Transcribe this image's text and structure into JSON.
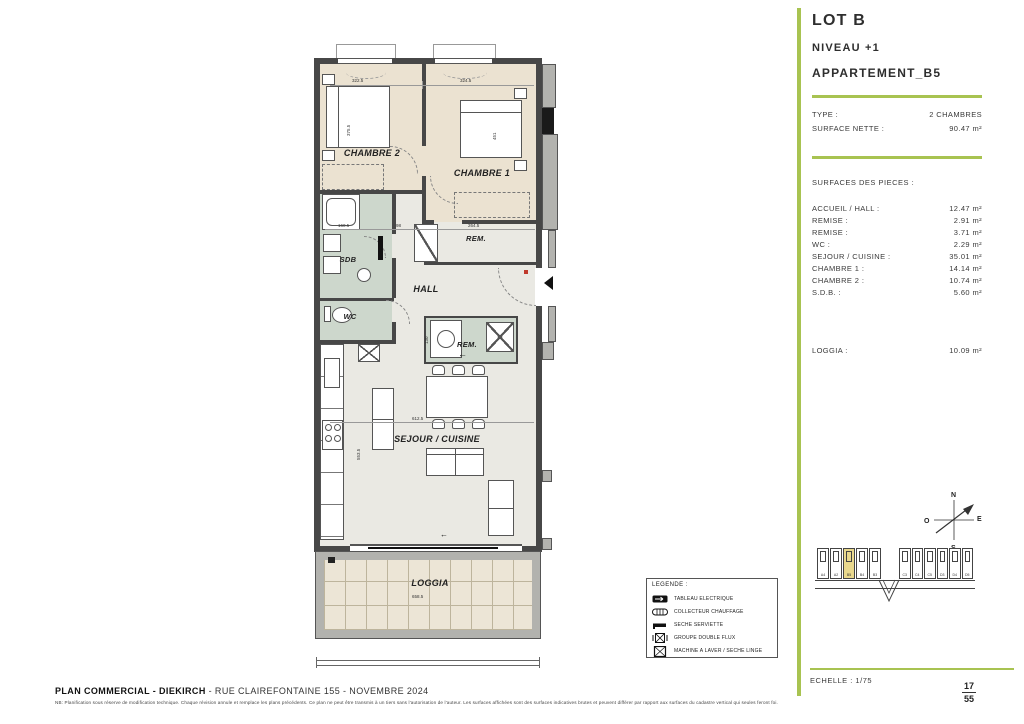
{
  "colors": {
    "accent_green": "#a8c351",
    "room_beige": "#ebe2d1",
    "room_wet": "#cdd7cc",
    "floor": "#eae9e3",
    "wall": "#474747",
    "poche": "#b3b3af",
    "highlight": "#e9d88d"
  },
  "plan": {
    "rooms": {
      "chambre2": "CHAMBRE 2",
      "chambre1": "CHAMBRE 1",
      "sdb": "SDB",
      "wc": "WC",
      "hall": "HALL",
      "rem_top": "REM.",
      "rem_center": "REM.",
      "sejour": "SEJOUR / CUISINE",
      "loggia": "LOGGIA"
    },
    "dimensions": [
      "322.5",
      "324.5",
      "375.5",
      "451",
      "160.5",
      "98",
      "264.5",
      "612.5",
      "553.5",
      "130",
      "658.5"
    ]
  },
  "legend": {
    "title": "LEGENDE :",
    "items": [
      "TABLEAU ELECTRIQUE",
      "COLLECTEUR CHAUFFAGE",
      "SECHE SERVIETTE",
      "GROUPE DOUBLE FLUX",
      "MACHINE A LAVER / SECHE LINGE"
    ]
  },
  "panel": {
    "lot": "LOT B",
    "niveau": "NIVEAU +1",
    "apartment": "APPARTEMENT_B5",
    "type_label": "TYPE :",
    "type_value": "2 CHAMBRES",
    "surface_label": "SURFACE NETTE :",
    "surface_value": "90.47 m²",
    "pieces_title": "SURFACES DES PIECES :",
    "pieces": [
      {
        "label": "ACCUEIL / HALL :",
        "value": "12.47 m²"
      },
      {
        "label": "REMISE :",
        "value": "2.91 m²"
      },
      {
        "label": "REMISE :",
        "value": "3.71 m²"
      },
      {
        "label": "WC :",
        "value": "2.29 m²"
      },
      {
        "label": "SEJOUR / CUISINE :",
        "value": "35.01 m²"
      },
      {
        "label": "CHAMBRE 1 :",
        "value": "14.14 m²"
      },
      {
        "label": "CHAMBRE 2 :",
        "value": "10.74 m²"
      },
      {
        "label": "S.D.B. :",
        "value": "5.60 m²"
      }
    ],
    "loggia_label": "LOGGIA :",
    "loggia_value": "10.09 m²",
    "compass": {
      "n": "N",
      "s": "S",
      "e": "E",
      "o": "O"
    },
    "keyplan": {
      "left_units": [
        "A4",
        "A2",
        "B5",
        "B4",
        "B3"
      ],
      "right_units": [
        "C3",
        "C4",
        "C5",
        "D3",
        "D4",
        "D5"
      ],
      "highlight": "B5"
    },
    "echelle": "ECHELLE : 1/75",
    "page": {
      "current": "17",
      "total": "55"
    }
  },
  "footer": {
    "title_bold": "PLAN COMMERCIAL - DIEKIRCH",
    "title_rest": " - RUE CLAIREFONTAINE 155 - NOVEMBRE 2024",
    "disclaimer": "NB: Planification sous réserve de modification technique. Chaque révision annule et remplace les plans précédents. Ce plan ne peut être transmis à un tiers sans l'autorisation de l'auteur. Les surfaces affichées sont des surfaces indicatives brutes et peuvent différer par rapport aux surfaces du cadastre vertical qui seules feront foi."
  }
}
